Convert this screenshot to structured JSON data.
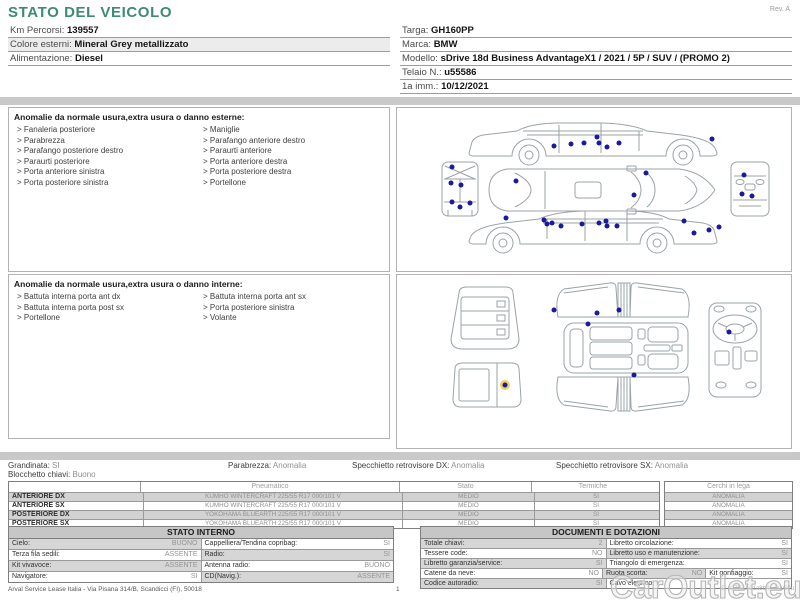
{
  "title": "STATO DEL VEICOLO",
  "rev": "Rev. A",
  "vehicle_info": {
    "left": [
      {
        "label": "Km Percorsi:",
        "value": "139557"
      },
      {
        "label": "Colore esterni:",
        "value": "Mineral Grey metallizzato"
      },
      {
        "label": "Alimentazione:",
        "value": "Diesel"
      }
    ],
    "right": [
      {
        "label": "Targa:",
        "value": "GH160PP"
      },
      {
        "label": "Marca:",
        "value": "BMW"
      },
      {
        "label": "Modello:",
        "value": "sDrive 18d Business AdvantageX1 / 2021 / 5P / SUV / (PROMO 2)"
      },
      {
        "label": "Telaio N.:",
        "value": "u55586"
      },
      {
        "label": "1a imm.:",
        "value": "10/12/2021"
      }
    ]
  },
  "exterior_anomalies": {
    "heading": "Anomalie da normale usura,extra usura o danno esterne:",
    "column_left": [
      "Fanaleria posteriore",
      "Parabrezza",
      "Parafango posteriore destro",
      "Paraurti posteriore",
      "Porta anteriore sinistra",
      "Porta posteriore sinistra"
    ],
    "column_right": [
      "Maniglie",
      "Parafango anteriore destro",
      "Paraurti anteriore",
      "Porta anteriore destra",
      "Porta posteriore destra",
      "Portellone"
    ]
  },
  "interior_anomalies": {
    "heading": "Anomalie da normale usura,extra usura o danno interne:",
    "column_left": [
      "Battuta interna porta ant dx",
      "Battuta interna porta post sx",
      "Portellone"
    ],
    "column_right": [
      "Battuta interna porta ant sx",
      "Porta posteriore sinistra",
      "Volante"
    ]
  },
  "summary": {
    "items": [
      {
        "label": "Grandinata:",
        "value": "SI"
      },
      {
        "label": "Blocchetto chiavi:",
        "value": "Buono"
      },
      {
        "label": "Parabrezza:",
        "value": "Anomalia"
      },
      {
        "label": "Specchietto retrovisore DX:",
        "value": "Anomalia"
      },
      {
        "label": "Specchietto retrovisore SX:",
        "value": "Anomalia"
      }
    ]
  },
  "tyre_table": {
    "col_pneumatico": "Pneumatico",
    "col_stato": "Stato",
    "col_termiche": "Termiche",
    "col_cerchi": "Cerchi in lega",
    "rows": [
      {
        "position": "ANTERIORE DX",
        "pneumatico": "KUMHO WINTERCRAFT 225/55 R17 000/101 V",
        "stato": "MEDIO",
        "termiche": "SI",
        "cerchi": "ANOMALIA"
      },
      {
        "position": "ANTERIORE SX",
        "pneumatico": "KUMHO WINTERCRAFT 225/55 R17 000/101 V",
        "stato": "MEDIO",
        "termiche": "SI",
        "cerchi": "ANOMALIA"
      },
      {
        "position": "POSTERIORE DX",
        "pneumatico": "YOKOHAMA BLUEARTH 225/55 R17 000/101 V",
        "stato": "MEDIO",
        "termiche": "SI",
        "cerchi": "ANOMALIA"
      },
      {
        "position": "POSTERIORE SX",
        "pneumatico": "YOKOHAMA BLUEARTH 225/55 R17 000/101 V",
        "stato": "MEDIO",
        "termiche": "SI",
        "cerchi": "ANOMALIA"
      }
    ]
  },
  "stato_interno": {
    "heading": "STATO INTERNO",
    "rows": [
      [
        {
          "label": "Cielo:",
          "value": "BUONO"
        },
        {
          "label": "Cappelliera/Tendina copribag:",
          "value": "SI"
        }
      ],
      [
        {
          "label": "Terza fila sedili:",
          "value": "ASSENTE"
        },
        {
          "label": "Radio:",
          "value": "SI"
        }
      ],
      [
        {
          "label": "Kit vivavoce:",
          "value": "ASSENTE"
        },
        {
          "label": "Antenna radio:",
          "value": "BUONO"
        }
      ],
      [
        {
          "label": "Navigatore:",
          "value": "SI"
        },
        {
          "label": "CD(Navig.):",
          "value": "ASSENTE"
        }
      ]
    ]
  },
  "documenti": {
    "heading": "DOCUMENTI E DOTAZIONI",
    "rows": [
      [
        {
          "label": "Totale chiavi:",
          "value": "2"
        },
        {
          "label": "Libretto circolazione:",
          "value": "SI"
        }
      ],
      [
        {
          "label": "Tessere code:",
          "value": "NO"
        },
        {
          "label": "Libretto uso e manutenzione:",
          "value": "SI"
        }
      ],
      [
        {
          "label": "Libretto garanzia/service:",
          "value": "SI"
        },
        {
          "label": "Triangolo di emergenza:",
          "value": "SI"
        }
      ],
      [
        {
          "label": "Catene da neve:",
          "value": "NO"
        },
        {
          "label": "Ruota scorta:",
          "value": "NO"
        },
        {
          "label": "Kit gonfiaggio:",
          "value": "SI"
        }
      ],
      [
        {
          "label": "Codice autoradio:",
          "value": "SI"
        },
        {
          "label": "Cavo elettrico:",
          "value": ""
        }
      ]
    ]
  },
  "footer": {
    "left": "Arval Service Lease Italia - Via Pisana 314/B, Scandicci (FI), 50018",
    "page": "1",
    "right": "ID u2793J-21a8b4 , 0uv60u"
  },
  "watermark": "CarOutlet.eu",
  "diagrams": {
    "dot_color": "#1a1a9c",
    "halo_color": "#efd060",
    "exterior_dots": [
      [
        157,
        38
      ],
      [
        174,
        36
      ],
      [
        187,
        35
      ],
      [
        200,
        29
      ],
      [
        202,
        35
      ],
      [
        210,
        39
      ],
      [
        222,
        35
      ],
      [
        315,
        31
      ],
      [
        55,
        59
      ],
      [
        54,
        75
      ],
      [
        64,
        77
      ],
      [
        55,
        94
      ],
      [
        63,
        99
      ],
      [
        73,
        95
      ],
      [
        119,
        73
      ],
      [
        249,
        65
      ],
      [
        237,
        87
      ],
      [
        347,
        67
      ],
      [
        345,
        86
      ],
      [
        355,
        88
      ],
      [
        109,
        110
      ],
      [
        147,
        112
      ],
      [
        150,
        116
      ],
      [
        155,
        115
      ],
      [
        164,
        118
      ],
      [
        185,
        116
      ],
      [
        202,
        115
      ],
      [
        209,
        113
      ],
      [
        210,
        118
      ],
      [
        220,
        118
      ],
      [
        287,
        113
      ],
      [
        297,
        125
      ],
      [
        312,
        122
      ],
      [
        322,
        119
      ]
    ],
    "interior_dots": [
      [
        157,
        35
      ],
      [
        200,
        38
      ],
      [
        222,
        35
      ],
      [
        191,
        49
      ],
      [
        237,
        100
      ],
      [
        332,
        57
      ]
    ],
    "interior_highlight_dot": [
      108,
      110
    ]
  },
  "colors": {
    "accent_green": "#3e8b70",
    "row_shade": "#d2d2d2",
    "bar_gray": "#c9c9c9",
    "dot_blue": "#1a1a9c"
  }
}
